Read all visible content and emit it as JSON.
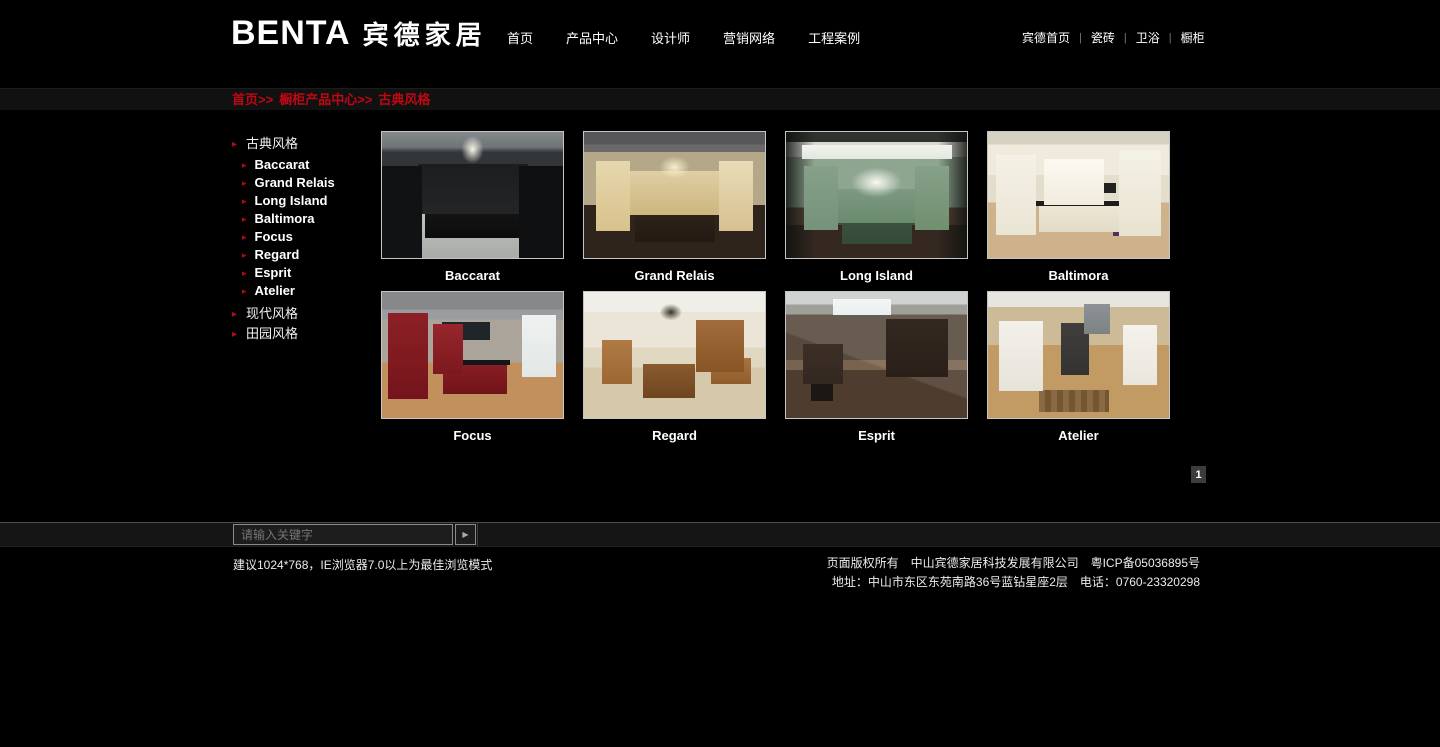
{
  "header": {
    "logo_en": "BENTA",
    "logo_cn": "宾德家居",
    "nav": [
      {
        "label": "首页"
      },
      {
        "label": "产品中心"
      },
      {
        "label": "设计师"
      },
      {
        "label": "营销网络"
      },
      {
        "label": "工程案例"
      }
    ],
    "site_links": [
      {
        "label": "宾德首页"
      },
      {
        "label": "瓷砖"
      },
      {
        "label": "卫浴"
      },
      {
        "label": "橱柜"
      }
    ],
    "separator": "|"
  },
  "breadcrumb": {
    "parts": [
      "首页>>",
      "橱柜产品中心>>",
      "古典风格"
    ]
  },
  "sidebar": {
    "categories": [
      {
        "label": "古典风格",
        "items": [
          {
            "label": "Baccarat"
          },
          {
            "label": "Grand Relais"
          },
          {
            "label": "Long Island"
          },
          {
            "label": "Baltimora"
          },
          {
            "label": "Focus"
          },
          {
            "label": "Regard"
          },
          {
            "label": "Esprit"
          },
          {
            "label": "Atelier"
          }
        ]
      },
      {
        "label": "现代风格"
      },
      {
        "label": "田园风格"
      }
    ]
  },
  "products": {
    "items": [
      {
        "label": "Baccarat",
        "scene": "dark-luxury-kitchen"
      },
      {
        "label": "Grand Relais",
        "scene": "cream-classic-kitchen"
      },
      {
        "label": "Long Island",
        "scene": "sage-green-kitchen"
      },
      {
        "label": "Baltimora",
        "scene": "white-classic-kitchen"
      },
      {
        "label": "Focus",
        "scene": "red-modern-kitchen"
      },
      {
        "label": "Regard",
        "scene": "wood-country-kitchen"
      },
      {
        "label": "Esprit",
        "scene": "dark-modern-living"
      },
      {
        "label": "Atelier",
        "scene": "white-loft-kitchen"
      }
    ]
  },
  "pagination": {
    "current": "1"
  },
  "search": {
    "placeholder": "请输入关键字",
    "button_glyph": "▶"
  },
  "footer": {
    "left": "建议1024*768，IE浏览器7.0以上为最佳浏览模式",
    "copyright": "页面版权所有　中山宾德家居科技发展有限公司　粤ICP备05036895号",
    "address": "地址：中山市东区东苑南路36号蓝钻星座2层　电话：0760-23320298"
  },
  "colors": {
    "accent_red": "#c00714",
    "page_bg": "#000000",
    "bar_bg": "#151515"
  }
}
